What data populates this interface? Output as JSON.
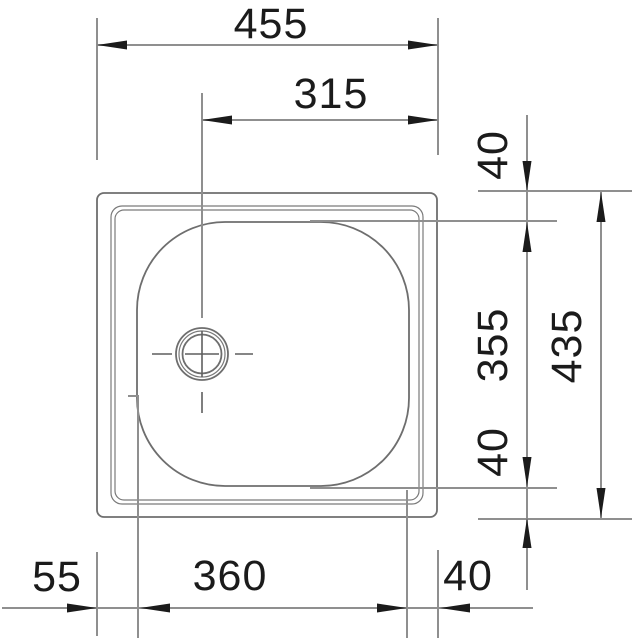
{
  "drawing": {
    "kind": "technical-dimension-diagram",
    "subject": "kitchen sink top view with single bowl and drain",
    "background": "#ffffff",
    "colors": {
      "dimension_lines": "#8f8f8f",
      "object_lines": "#6e6e6e",
      "arrows_and_text": "#1b1b1b"
    }
  },
  "dims": {
    "overall_width": "455",
    "drain_center_to_right_edge": "315",
    "top_edge_to_bowl": "40",
    "bowl_depth_front_back": "355",
    "overall_depth": "435",
    "bowl_to_bottom_edge": "40",
    "left_edge_to_bowl": "55",
    "bowl_width": "360",
    "bowl_to_right_edge": "40"
  }
}
